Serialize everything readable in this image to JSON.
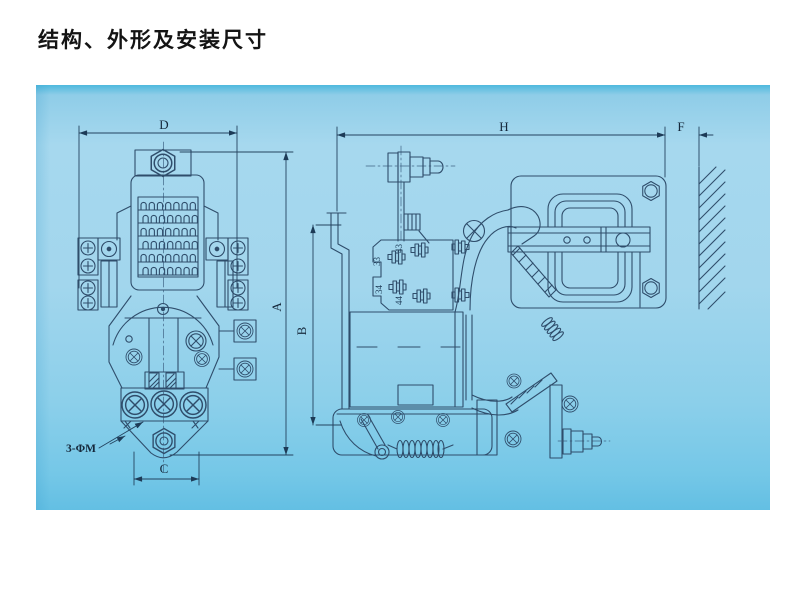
{
  "title": "结构、外形及安装尺寸",
  "drawing": {
    "type": "engineering-dimension-drawing",
    "subject": "contactor structure, outline and mounting dimensions",
    "views": {
      "front": {
        "dims": {
          "top_width": "D",
          "overall_height": "A",
          "bottom_width": "C"
        },
        "note": "3-ΦM"
      },
      "side": {
        "dims": {
          "bracket_height": "B",
          "overall_depth": "H",
          "wall_clearance": "F"
        },
        "terminals": [
          "43",
          "33",
          "34",
          "44"
        ]
      }
    },
    "colors": {
      "panel_blue_top": "#4fb9dd",
      "panel_blue": "#a3d6ec",
      "panel_blue_bottom": "#63bfe3",
      "line_color": "#2f4d6b",
      "dim_text_color": "#16293c",
      "title_color": "#141414",
      "page_background": "#ffffff"
    }
  }
}
